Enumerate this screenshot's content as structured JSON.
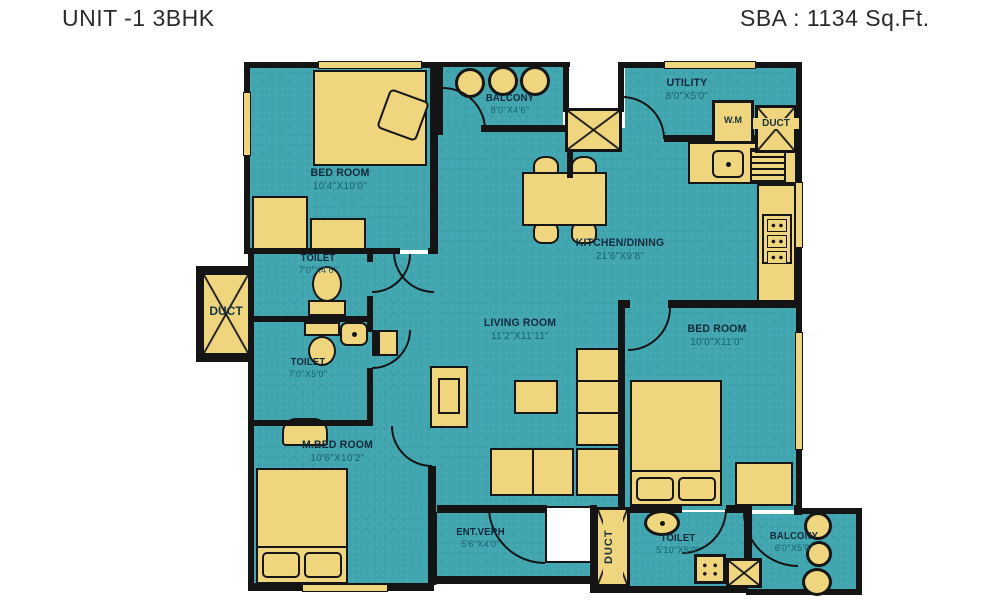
{
  "header": {
    "title": "UNIT -1 3BHK",
    "sba": "SBA : 1134 Sq.Ft."
  },
  "rooms": {
    "bedroom_top_left": {
      "name": "BED ROOM",
      "dims": "10'4\"X10'0\""
    },
    "balcony_top": {
      "name": "BALCONY",
      "dims": "8'0\"X4'6\""
    },
    "utility": {
      "name": "UTILITY",
      "dims": "8'0\"X5'0\""
    },
    "kitchen_dining": {
      "name": "KITCHEN/DINING",
      "dims": "21'6\"X9'8\""
    },
    "toilet_upper": {
      "name": "TOILET",
      "dims": "7'0\"X4'6\""
    },
    "toilet_lower": {
      "name": "TOILET",
      "dims": "7'0\"X5'0\""
    },
    "living_room": {
      "name": "LIVING ROOM",
      "dims": "11'2\"X11'11\""
    },
    "bedroom_right": {
      "name": "BED ROOM",
      "dims": "10'0\"X11'0\""
    },
    "master_bedroom": {
      "name": "M.BED ROOM",
      "dims": "10'6\"X10'2\""
    },
    "entrance_verandah": {
      "name": "ENT.VERH",
      "dims": "5'6\"X4'0\""
    },
    "toilet_bottom": {
      "name": "TOILET",
      "dims": "5'10\"X5'0\""
    },
    "balcony_bottom": {
      "name": "BALCONY",
      "dims": "6'0\"X5'0\""
    }
  },
  "fixtures": {
    "washing_machine": "W.M",
    "duct_left": "DUCT",
    "duct_utility": "DUCT",
    "duct_bottom": "DUCT"
  },
  "colors": {
    "floor": "#41a6b0",
    "fixture": "#f0d57f",
    "wall": "#141414",
    "name_text": "#11293a",
    "dim_text": "#1d5f6e",
    "page_bg": "#ffffff",
    "title_text": "#2b2b2b"
  }
}
